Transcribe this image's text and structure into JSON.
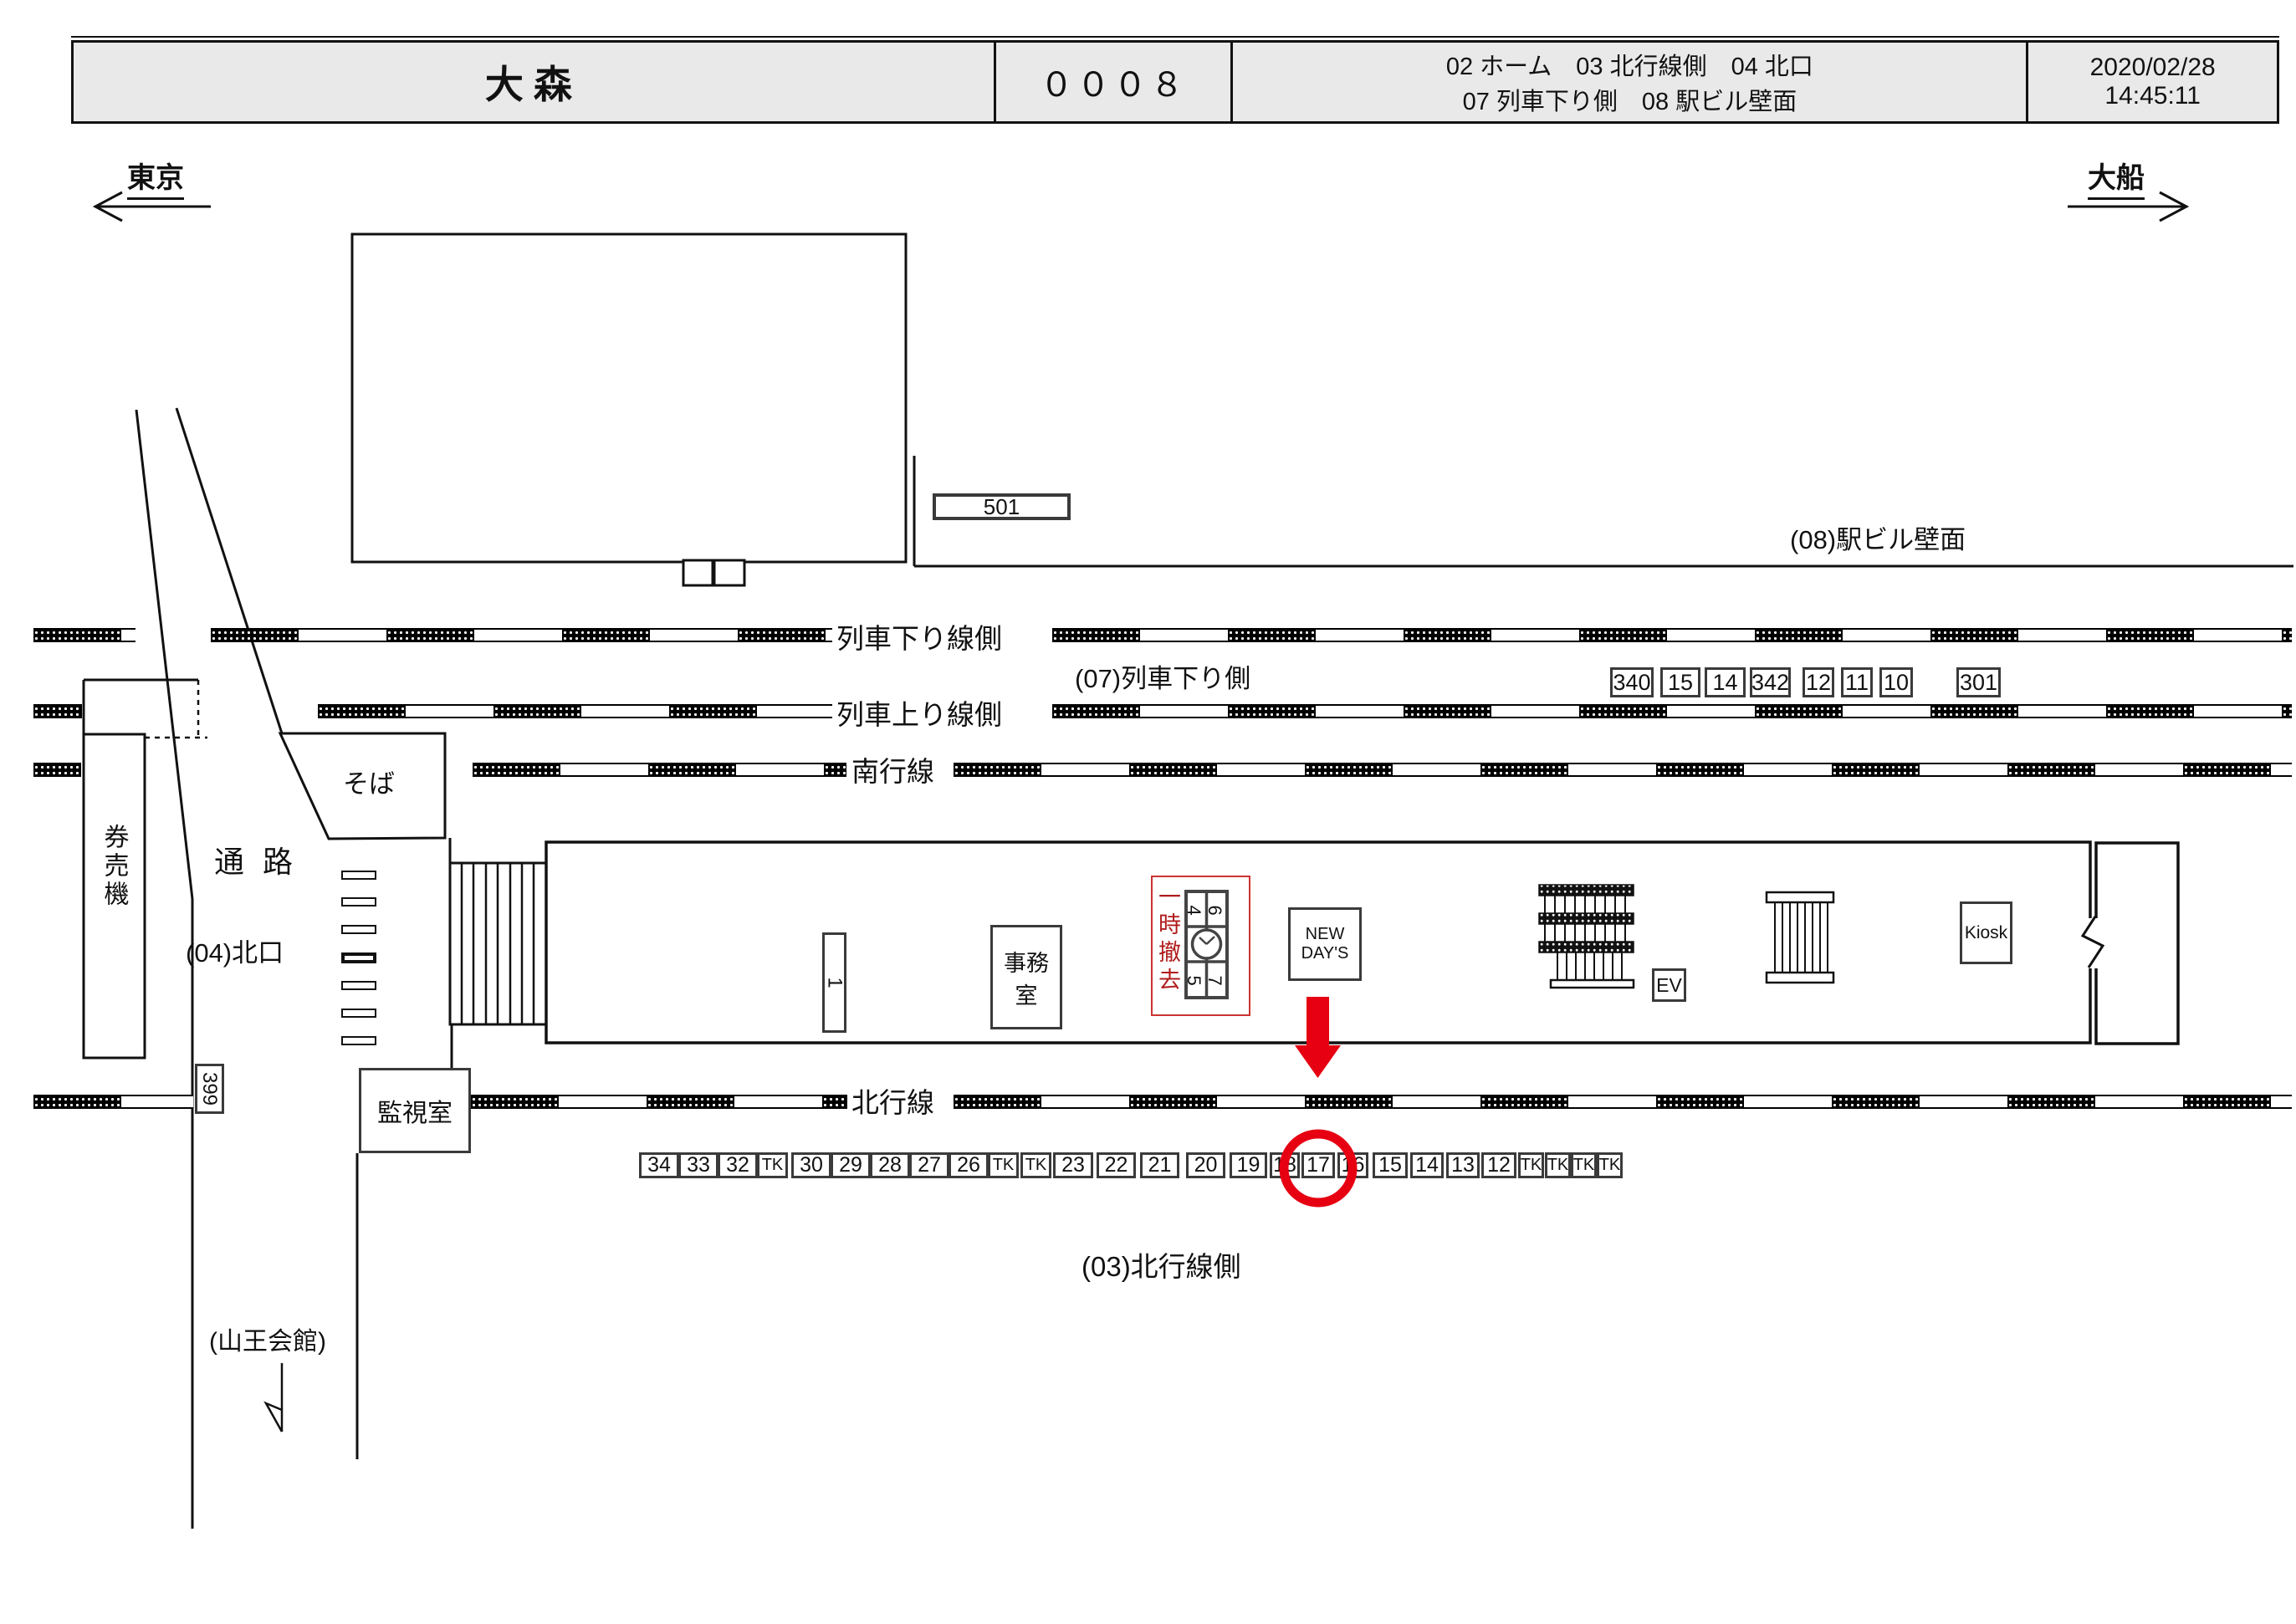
{
  "header": {
    "station": "大森",
    "code": "０００８",
    "categories_line1": "02 ホーム　03 北行線側　04 北口",
    "categories_line2": "07 列車下り側　08 駅ビル壁面",
    "date": "2020/02/28",
    "time": "14:45:11"
  },
  "directions": {
    "left": "東京",
    "right": "大船"
  },
  "track_labels": {
    "down_side": "列車下り線側",
    "down_area": "(07)列車下り側",
    "up_side": "列車上り線側",
    "south_line": "南行線",
    "north_line": "北行線",
    "north_area": "(03)北行線側",
    "wall_area": "(08)駅ビル壁面"
  },
  "places": {
    "passage": "通 路",
    "north_exit": "(04)北口",
    "ticket_machines": "券売機",
    "soba": "そば",
    "monitor_room": "監視室",
    "office_line1": "事務",
    "office_line2": "室",
    "newdays_line1": "NEW",
    "newdays_line2": "DAY'S",
    "elevator": "EV",
    "kiosk": "Kiosk",
    "sanno_hall": "(山王会館)",
    "temp_removed": "一時撤去"
  },
  "ad_ids": {
    "wall": "501",
    "gate": "399",
    "platform_single": "1",
    "clock_group": [
      "4",
      "6",
      "5",
      "7"
    ],
    "upper_row": [
      "340",
      "15",
      "14",
      "342",
      "12",
      "11",
      "10",
      "301"
    ],
    "lower_row": [
      "34",
      "33",
      "32",
      "TK",
      "30",
      "29",
      "28",
      "27",
      "26",
      "TK",
      "TK",
      "23",
      "22",
      "21",
      "20",
      "19",
      "18",
      "17",
      "16",
      "15",
      "14",
      "13",
      "12",
      "TK",
      "TK",
      "TK",
      "TK"
    ],
    "highlighted": "17"
  },
  "colors": {
    "highlight_red": "#e60012",
    "removed_red": "#b01c1c",
    "line": "#111111",
    "header_bg": "#e9e9e9"
  }
}
